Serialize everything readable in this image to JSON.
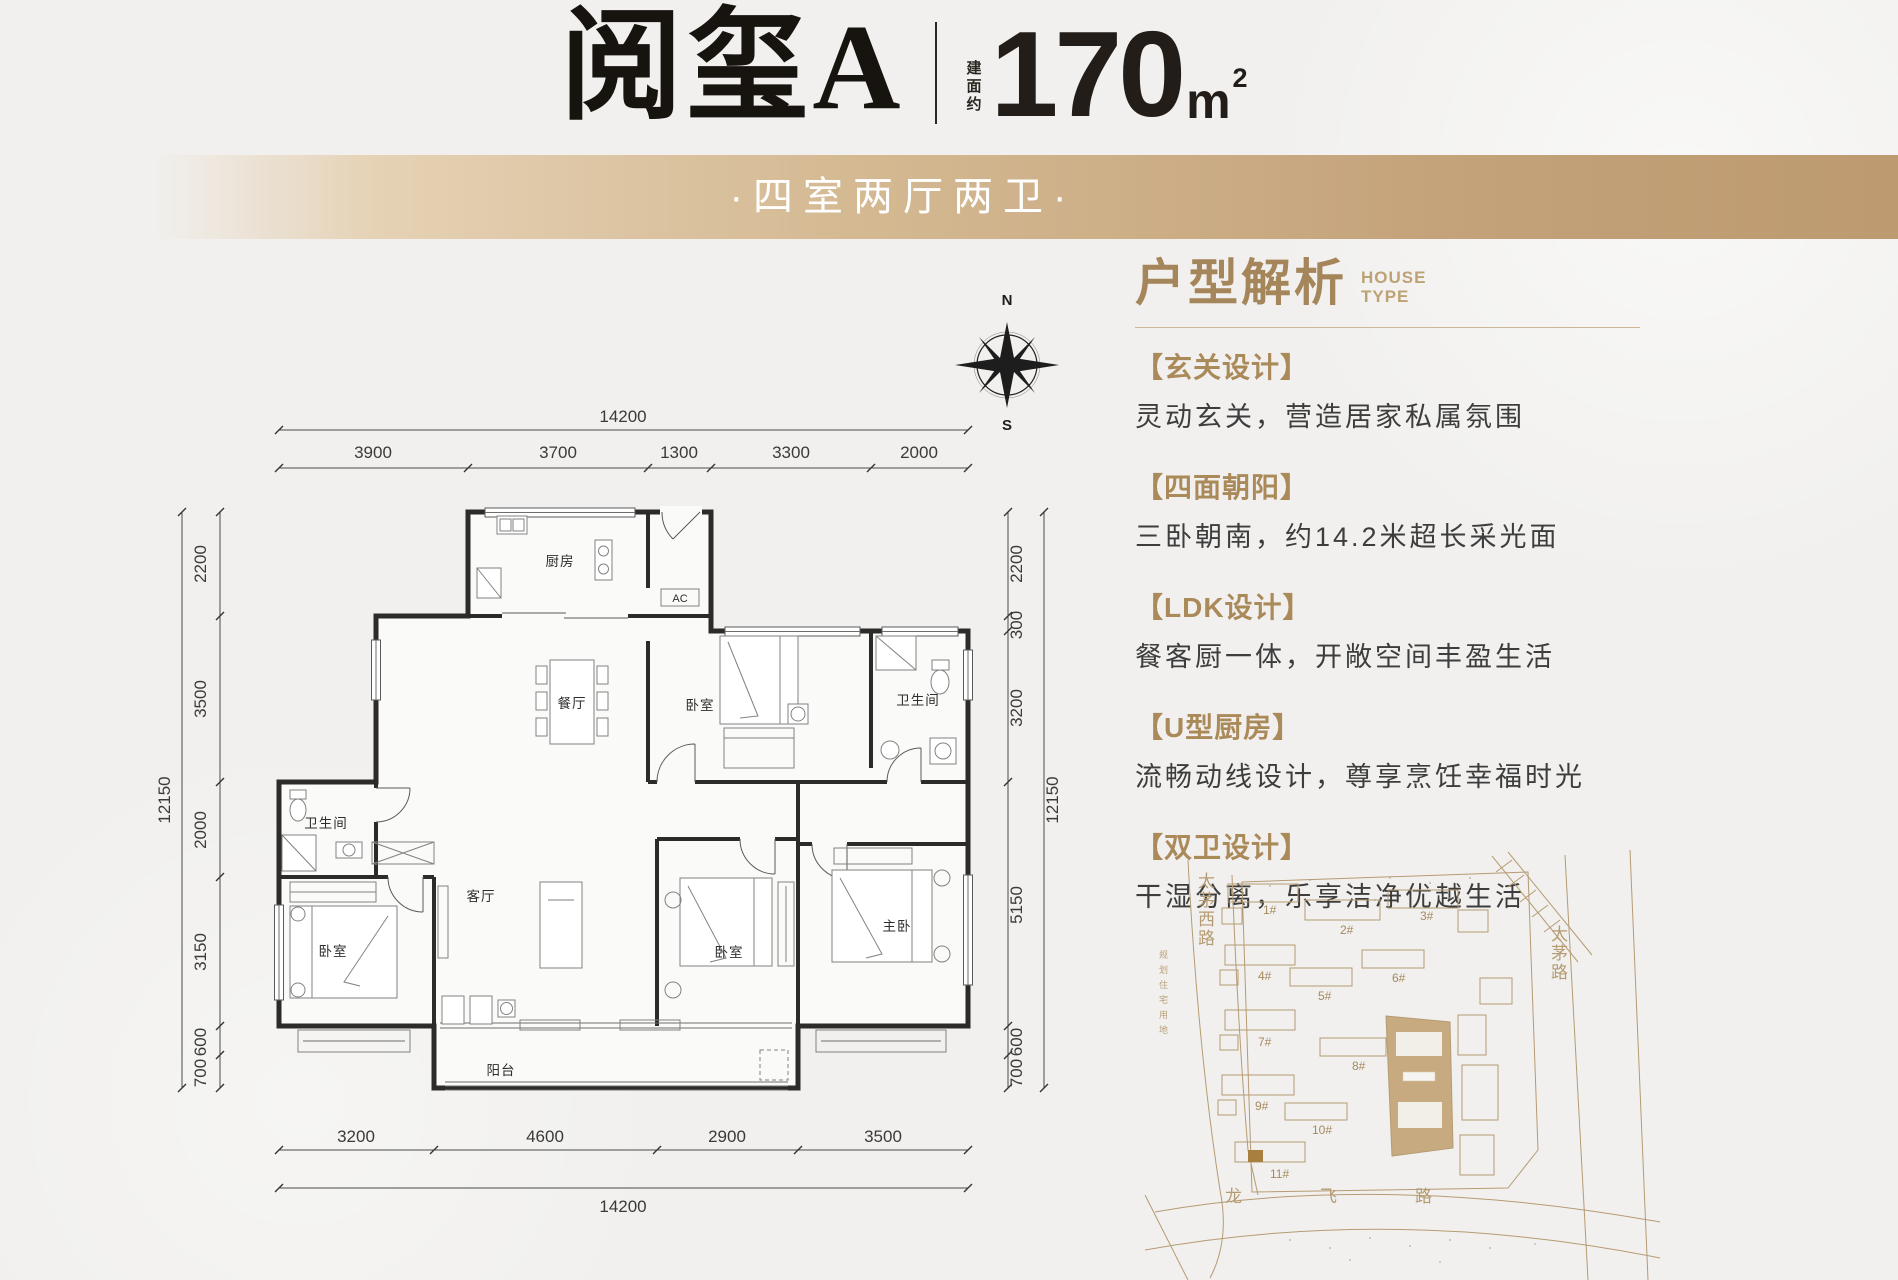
{
  "header": {
    "title": "阅玺A",
    "area_label": "建面约",
    "area_value": "170",
    "area_unit": "m",
    "area_sup": "2"
  },
  "banner": {
    "text": "·四室两厅两卫·"
  },
  "analysis": {
    "title": "户型解析",
    "subtitle_line1": "HOUSE",
    "subtitle_line2": "TYPE",
    "sections": [
      {
        "heading": "【玄关设计】",
        "body": "灵动玄关，营造居家私属氛围"
      },
      {
        "heading": "【四面朝阳】",
        "body": "三卧朝南，约14.2米超长采光面"
      },
      {
        "heading": "【LDK设计】",
        "body": "餐客厨一体，开敞空间丰盈生活"
      },
      {
        "heading": "【U型厨房】",
        "body": "流畅动线设计，尊享烹饪幸福时光"
      },
      {
        "heading": "【双卫设计】",
        "body": "干湿分离，乐享洁净优越生活"
      }
    ]
  },
  "compass": {
    "north": "N",
    "south": "S"
  },
  "floorplan": {
    "rooms": {
      "kitchen": "厨房",
      "ac": "AC",
      "dining": "餐厅",
      "bedroom_top": "卧室",
      "bath_top": "卫生间",
      "bath_left": "卫生间",
      "bedroom_left": "卧室",
      "living": "客厅",
      "bedroom_mid": "卧室",
      "master": "主卧",
      "balcony": "阳台"
    },
    "dims": {
      "top_total": "14200",
      "top": [
        "3900",
        "3700",
        "1300",
        "3300",
        "2000"
      ],
      "left_total": "12150",
      "left": [
        "2200",
        "3500",
        "2000",
        "3150",
        "600",
        "700"
      ],
      "right_total": "12150",
      "right": [
        "2200",
        "300",
        "3200",
        "5150",
        "600",
        "700"
      ],
      "bottom": [
        "3200",
        "4600",
        "2900",
        "3500"
      ],
      "bottom_total": "14200"
    }
  },
  "siteplan": {
    "buildings": [
      "1#",
      "2#",
      "3#",
      "4#",
      "5#",
      "6#",
      "7#",
      "8#",
      "9#",
      "10#",
      "11#"
    ],
    "roads": {
      "west": "太茅西路",
      "east": "太茅路",
      "south": "龙飞路"
    },
    "land_note": "规划住宅用地"
  }
}
